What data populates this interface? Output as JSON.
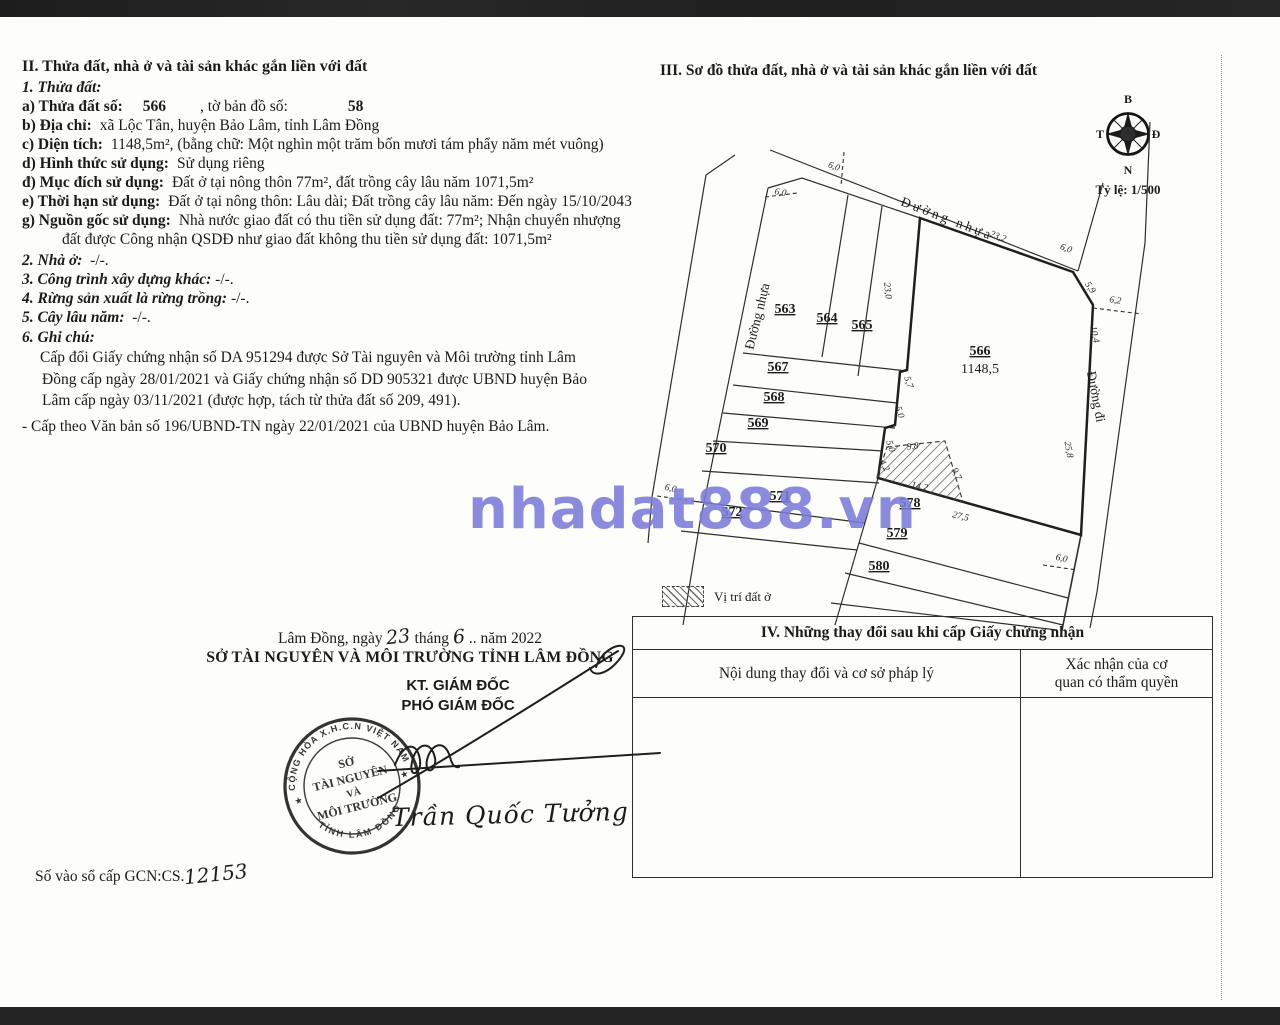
{
  "section2": {
    "heading": "II. Thửa đất, nhà ở và tài sản khác gắn liền với đất",
    "sub1": "1. Thửa đất:",
    "line_a": {
      "label": "a) Thửa đất số:",
      "value1": "566",
      "mid": ", tờ bản đồ số:",
      "value2": "58"
    },
    "line_b": {
      "label": "b) Địa chỉ:",
      "value": "xã Lộc Tân, huyện Bảo Lâm, tỉnh Lâm Đồng"
    },
    "line_c": {
      "label": "c) Diện tích:",
      "value": "1148,5m², (bằng chữ: Một nghìn một trăm bốn mươi tám phẩy năm mét vuông)"
    },
    "line_d": {
      "label": "d) Hình thức sử dụng:",
      "value": "Sử dụng riêng"
    },
    "line_dd": {
      "label": "đ) Mục đích sử dụng:",
      "value": "Đất ở tại nông thôn 77m², đất trồng cây lâu năm 1071,5m²"
    },
    "line_e": {
      "label": "e) Thời hạn sử dụng:",
      "value": "Đất ở tại nông thôn: Lâu dài; Đất trồng cây lâu năm: Đến ngày 15/10/2043"
    },
    "line_g": {
      "label": "g) Nguồn gốc sử dụng:",
      "value": "Nhà nước giao đất có thu tiền sử dụng đất: 77m²; Nhận chuyển nhượng đất được Công nhận QSDĐ như giao đất không thu tiền sử dụng đất: 1071,5m²"
    },
    "line_2": {
      "label": "2. Nhà ở:",
      "value": "-/-."
    },
    "line_3": {
      "label": "3. Công trình xây dựng khác:",
      "value": "-/-."
    },
    "line_4": {
      "label": "4. Rừng sản xuất là rừng trồng:",
      "value": "-/-."
    },
    "line_5": {
      "label": "5. Cây lâu năm:",
      "value": "-/-."
    },
    "line_6": {
      "label": "6. Ghi chú:"
    },
    "note1": "Cấp đổi Giấy chứng nhận số DA 951294 được Sở Tài nguyên và Môi trường tỉnh Lâm Đồng cấp ngày 28/01/2021 và Giấy chứng nhận số DD 905321 được UBND huyện Bảo Lâm cấp ngày 03/11/2021 (được hợp, tách từ thửa đất số 209, 491).",
    "note2": "- Cấp theo Văn bản số 196/UBND-TN ngày 22/01/2021 của UBND huyện Bảo Lâm."
  },
  "signature": {
    "date_prefix": "Lâm Đồng, ngày",
    "day": "23",
    "month_label": "tháng",
    "month": "6",
    "year_suffix": ".. năm 2022",
    "org": "SỞ TÀI NGUYÊN VÀ MÔI TRƯỜNG TỈNH LÂM ĐỒNG",
    "title1": "KT. GIÁM ĐỐC",
    "title2": "PHÓ GIÁM ĐỐC",
    "signer_name": "Trần Quốc Tưởng",
    "book_label": "Số vào sổ cấp GCN:CS.",
    "book_number": "12153"
  },
  "stamp": {
    "ring_top": "CỘNG HÒA X.H.C.N VIỆT NAM",
    "ring_bottom": "TỈNH LÂM ĐỒNG",
    "star": "★",
    "center": [
      "SỞ",
      "TÀI NGUYÊN",
      "VÀ",
      "MÔI TRƯỜNG"
    ]
  },
  "section3": {
    "heading": "III. Sơ đồ thửa đất, nhà ở và tài sản khác gắn liền với đất",
    "compass": {
      "north": "B",
      "south": "N",
      "west": "T",
      "east": "Đ"
    },
    "scale": "Tỷ lệ: 1/500",
    "legend": "Vị trí đất ở"
  },
  "map": {
    "roads": {
      "top": "Đường nhựa",
      "left": "Đường nhựa",
      "right": "Đường đi"
    },
    "parcels": [
      {
        "id": "563"
      },
      {
        "id": "564"
      },
      {
        "id": "565"
      },
      {
        "id": "566",
        "area": "1148,5"
      },
      {
        "id": "567"
      },
      {
        "id": "568"
      },
      {
        "id": "569"
      },
      {
        "id": "570"
      },
      {
        "id": "571"
      },
      {
        "id": "572"
      },
      {
        "id": "578"
      },
      {
        "id": "579"
      },
      {
        "id": "580"
      }
    ],
    "dims": [
      "6,0",
      "6,0",
      "23,2",
      "6,0",
      "5,9",
      "6,2",
      "10,4",
      "25,8",
      "23,0",
      "5,7",
      "5,0",
      "5,0",
      "4,2",
      "9,8",
      "9,7",
      "14,2",
      "27,5",
      "6,0",
      "6,0"
    ]
  },
  "section4": {
    "heading": "IV. Những thay đổi sau khi cấp Giấy chứng nhận",
    "col1": "Nội dung thay đổi và cơ sở pháp lý",
    "col2": "Xác nhận của cơ quan có thẩm quyền"
  },
  "watermark": "nhadat888.vn"
}
